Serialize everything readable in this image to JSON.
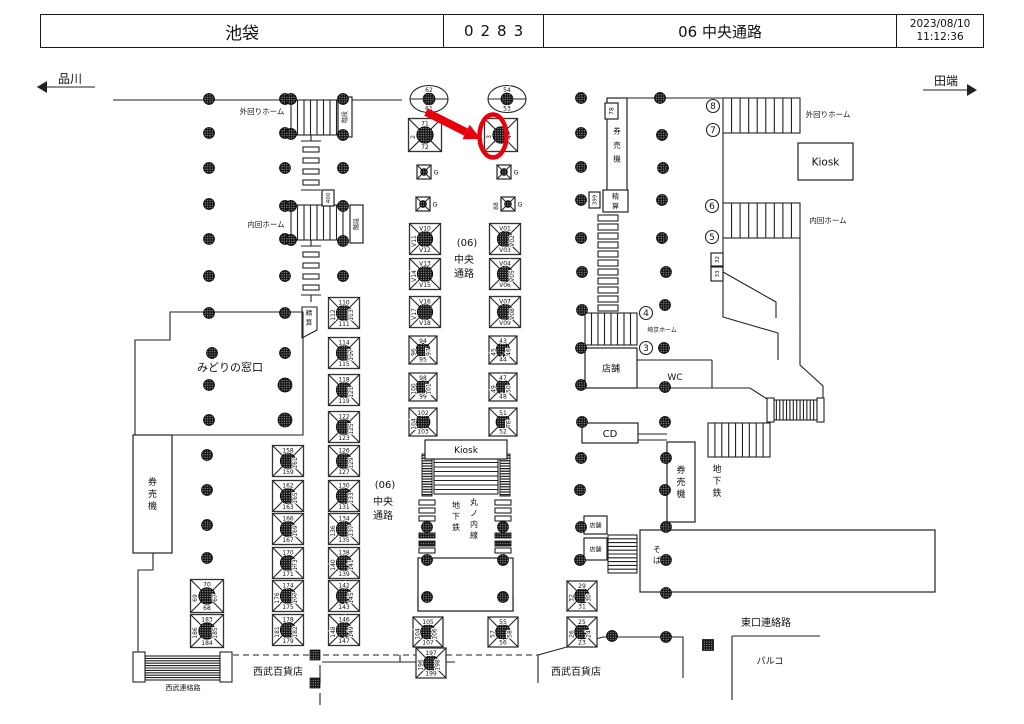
{
  "header": {
    "station": "池袋",
    "code": "0283",
    "location": "06 中央通路",
    "date": "2023/08/10",
    "time": "11:12:36"
  },
  "directions": {
    "left": "品川",
    "right": "田端"
  },
  "annotation": {
    "color": "#e8000b",
    "arrow": [
      426,
      112,
      466,
      132
    ],
    "arrow_head": [
      [
        481,
        139
      ],
      [
        462.4,
        139.2
      ],
      [
        469.6,
        124.8
      ]
    ],
    "ellipse": [
      493,
      136,
      13.5,
      21.5
    ]
  },
  "map": {
    "labels": [
      {
        "t": "品川",
        "x": 70,
        "y": 83,
        "s": 12,
        "n": "direction-left-label"
      },
      {
        "t": "田端",
        "x": 946,
        "y": 85,
        "s": 12,
        "n": "direction-right-label"
      },
      {
        "t": "外回りホーム",
        "x": 262,
        "y": 114,
        "s": 7.5
      },
      {
        "t": "内回ホーム",
        "x": 266,
        "y": 227,
        "s": 7.5
      },
      {
        "t": "外回りホーム",
        "x": 828,
        "y": 117,
        "s": 7.5
      },
      {
        "t": "内回ホーム",
        "x": 828,
        "y": 223,
        "s": 7.5
      },
      {
        "t": "みどりの窓口",
        "x": 230,
        "y": 371,
        "s": 11
      },
      {
        "t": "埼京ホーム",
        "x": 662,
        "y": 332,
        "s": 6
      },
      {
        "t": "WC",
        "x": 675,
        "y": 380,
        "s": 9
      },
      {
        "t": "東口連絡路",
        "x": 766,
        "y": 626,
        "s": 10
      },
      {
        "t": "パルコ",
        "x": 770,
        "y": 664,
        "s": 9
      },
      {
        "t": "西武百貨店",
        "x": 278,
        "y": 675,
        "s": 10
      },
      {
        "t": "西武百貨店",
        "x": 576,
        "y": 675,
        "s": 10
      },
      {
        "t": "西武連絡路",
        "x": 183,
        "y": 690,
        "s": 7
      },
      {
        "t": "(06)",
        "x": 467,
        "y": 246,
        "s": 10
      },
      {
        "t": "中央",
        "x": 464,
        "y": 263,
        "s": 10
      },
      {
        "t": "通路",
        "x": 464,
        "y": 277,
        "s": 10
      },
      {
        "t": "(06)",
        "x": 385,
        "y": 488,
        "s": 10
      },
      {
        "t": "中央",
        "x": 383,
        "y": 505,
        "s": 10
      },
      {
        "t": "通路",
        "x": 383,
        "y": 519,
        "s": 10
      },
      {
        "t": "地下鉄",
        "x": 456,
        "y": 508,
        "s": 8,
        "v": 1
      },
      {
        "t": "丸ノ内線",
        "x": 474,
        "y": 505,
        "s": 8,
        "v": 1
      },
      {
        "t": "地下鉄",
        "x": 717,
        "y": 472,
        "s": 9,
        "v": 1
      },
      {
        "t": "そば",
        "x": 657,
        "y": 552,
        "s": 8,
        "v": 1
      },
      {
        "t": "精算",
        "x": 309,
        "y": 315,
        "s": 6.5,
        "v": 1
      }
    ],
    "boxes": [
      {
        "x": 425,
        "y": 440,
        "w": 82,
        "h": 19,
        "t": "Kiosk",
        "s": 9
      },
      {
        "x": 798,
        "y": 143,
        "w": 55,
        "h": 37,
        "t": "Kiosk",
        "s": 10.5
      },
      {
        "x": 582,
        "y": 423,
        "w": 56,
        "h": 20,
        "t": "CD",
        "s": 10
      },
      {
        "x": 585,
        "y": 348,
        "w": 52,
        "h": 40,
        "t": "店舗",
        "s": 9
      },
      {
        "x": 584,
        "y": 516,
        "w": 23,
        "h": 18,
        "t": "店舗",
        "s": 6
      },
      {
        "x": 584,
        "y": 538,
        "w": 23,
        "h": 22,
        "t": "店舗",
        "s": 6
      },
      {
        "x": 418,
        "y": 597,
        "w": 95,
        "h": 14,
        "t": "店舗",
        "s": 9
      },
      {
        "x": 133,
        "y": 435,
        "w": 39,
        "h": 118,
        "t": "券売機",
        "s": 9,
        "v": 1
      },
      {
        "x": 607,
        "y": 98,
        "w": 20,
        "h": 94,
        "t": "券売機",
        "s": 7.5,
        "v": 1,
        "dy": 14
      },
      {
        "x": 667,
        "y": 442,
        "w": 28,
        "h": 80,
        "t": "券売機",
        "s": 9,
        "v": 1
      },
      {
        "x": 603,
        "y": 190,
        "w": 25,
        "h": 22,
        "t": "精算",
        "s": 7,
        "v": 1
      },
      {
        "x": 605,
        "y": 103,
        "w": 13,
        "h": 16,
        "t": "78",
        "s": 6,
        "r": 1
      },
      {
        "x": 589,
        "y": 192,
        "w": 11,
        "h": 16,
        "t": "399",
        "s": 5.5,
        "r": 1
      },
      {
        "x": 322,
        "y": 190,
        "w": 12,
        "h": 16,
        "t": "400",
        "s": 5.5,
        "r": 1
      },
      {
        "x": 711,
        "y": 253,
        "w": 12,
        "h": 13,
        "t": "32",
        "s": 5.5,
        "r": 1
      },
      {
        "x": 711,
        "y": 267,
        "w": 12,
        "h": 14,
        "t": "33",
        "s": 5.5,
        "r": 1
      },
      {
        "x": 338,
        "y": 97,
        "w": 14,
        "h": 40,
        "t": "階段",
        "s": 6,
        "r": 1
      },
      {
        "x": 350,
        "y": 205,
        "w": 13,
        "h": 38,
        "t": "階段",
        "s": 6,
        "r": 1
      },
      {
        "x": 640,
        "y": 530,
        "w": 295,
        "h": 62
      },
      {
        "x": 418,
        "y": 558,
        "w": 95,
        "h": 53
      }
    ],
    "signs": [
      [
        425,
        135,
        33,
        "71",
        "2",
        null,
        "72"
      ],
      [
        501,
        135,
        33,
        null,
        "3",
        "4",
        null
      ],
      [
        425,
        239,
        31,
        "V10",
        "V11",
        null,
        "V12"
      ],
      [
        425,
        274,
        31,
        "V13",
        "V14",
        null,
        "V15"
      ],
      [
        425,
        312,
        31,
        "V16",
        "V17",
        null,
        "V18"
      ],
      [
        505,
        239,
        31,
        "V01",
        null,
        "V02",
        "V03"
      ],
      [
        505,
        274,
        31,
        "V04",
        null,
        "V05",
        "V06"
      ],
      [
        505,
        312,
        31,
        "V07",
        null,
        "V08",
        "V09"
      ],
      [
        423,
        350,
        28,
        "94",
        "96",
        "97",
        "95"
      ],
      [
        423,
        387,
        28,
        "98",
        "100",
        "101",
        "99"
      ],
      [
        423,
        422,
        28,
        "102",
        "104",
        null,
        "103"
      ],
      [
        503,
        350,
        28,
        "43",
        "45",
        "46",
        "44"
      ],
      [
        503,
        387,
        28,
        "47",
        "49",
        "50",
        "48"
      ],
      [
        503,
        422,
        28,
        "51",
        null,
        "TC",
        "52"
      ],
      [
        344,
        313,
        31,
        "110",
        "112",
        "113",
        "111"
      ],
      [
        344,
        353,
        31,
        "114",
        null,
        "117",
        "115"
      ],
      [
        344,
        390,
        31,
        "118",
        null,
        "121",
        "119"
      ],
      [
        344,
        427,
        31,
        "122",
        null,
        "125",
        "123"
      ],
      [
        344,
        461,
        31,
        "126",
        null,
        "129",
        "127"
      ],
      [
        344,
        496,
        31,
        "130",
        null,
        "133",
        "131"
      ],
      [
        344,
        529,
        31,
        "134",
        "136",
        "137",
        "135"
      ],
      [
        344,
        563,
        31,
        "138",
        "140",
        "141",
        "139"
      ],
      [
        344,
        596,
        31,
        "142",
        null,
        "145",
        "143"
      ],
      [
        344,
        630,
        31,
        "146",
        "148",
        "149",
        "147"
      ],
      [
        288,
        461,
        31,
        "158",
        null,
        "161",
        "159"
      ],
      [
        288,
        496,
        31,
        "162",
        null,
        "165",
        "163"
      ],
      [
        288,
        529,
        31,
        "166",
        null,
        "169",
        "167"
      ],
      [
        288,
        563,
        31,
        "170",
        null,
        "173",
        "171"
      ],
      [
        288,
        596,
        31,
        "174",
        "176",
        "177",
        "175"
      ],
      [
        288,
        630,
        31,
        "178",
        "181",
        "182",
        "179"
      ],
      [
        207,
        596,
        33,
        "70",
        "69",
        "67",
        "68"
      ],
      [
        207,
        631,
        33,
        "183",
        "186",
        "185",
        "184"
      ],
      [
        428,
        632,
        30,
        "105",
        "104",
        "106",
        "107"
      ],
      [
        503,
        632,
        30,
        "55",
        "57",
        "58",
        "56"
      ],
      [
        431,
        663,
        30,
        "197",
        "196",
        "198",
        "199"
      ],
      [
        582,
        596,
        30,
        "29",
        "32",
        "30",
        "31"
      ],
      [
        582,
        632,
        30,
        "25",
        "26",
        "24",
        "23"
      ]
    ],
    "g_signs": [
      [
        424,
        172,
        "G",
        null
      ],
      [
        504,
        172,
        "G",
        null
      ],
      [
        423,
        204,
        "G",
        null
      ],
      [
        508,
        204,
        "G",
        "88"
      ]
    ],
    "ellipse_pillars": [
      [
        429,
        99,
        "62",
        "61"
      ],
      [
        507,
        99,
        "54",
        "53"
      ]
    ],
    "circled_numbers": [
      [
        713,
        106,
        "8"
      ],
      [
        713,
        130,
        "7"
      ],
      [
        712,
        206,
        "6"
      ],
      [
        712,
        237,
        "5"
      ],
      [
        646,
        313,
        "4"
      ],
      [
        646,
        348,
        "3"
      ]
    ],
    "stairs": [
      [
        291,
        100,
        52,
        35,
        "v",
        7
      ],
      [
        291,
        205,
        52,
        35,
        "v",
        7
      ],
      [
        723,
        98,
        77,
        35,
        "v",
        8
      ],
      [
        723,
        203,
        77,
        35,
        "v",
        8
      ],
      [
        585,
        313,
        52,
        32,
        "v",
        7
      ],
      [
        434,
        458,
        64,
        36,
        "h",
        7
      ],
      [
        428,
        562,
        74,
        31,
        "h",
        8
      ],
      [
        145,
        656,
        75,
        24,
        "h",
        9
      ],
      [
        708,
        423,
        62,
        34,
        "v",
        8
      ],
      [
        773,
        400,
        44,
        20,
        "v",
        12
      ],
      [
        608,
        535,
        29,
        38,
        "h",
        9
      ]
    ],
    "escalator_strips": [
      [
        422,
        454,
        10,
        42
      ],
      [
        500,
        454,
        10,
        42
      ]
    ],
    "caps": [
      [
        133,
        652,
        12,
        30
      ],
      [
        220,
        652,
        12,
        30
      ],
      [
        767,
        398,
        7,
        24
      ],
      [
        817,
        398,
        7,
        24
      ],
      [
        420,
        562,
        8,
        31
      ],
      [
        502,
        562,
        8,
        31
      ]
    ],
    "ladders": [
      {
        "x": 303,
        "w": 16,
        "h": 5,
        "ys": [
          147,
          158,
          169,
          180
        ]
      },
      {
        "x": 303,
        "w": 16,
        "h": 5,
        "ys": [
          252,
          263,
          274,
          285
        ]
      },
      {
        "x": 598,
        "w": 20,
        "h": 6,
        "ys": [
          215,
          224,
          233,
          242,
          251,
          260,
          269,
          278,
          287,
          296,
          305
        ]
      },
      {
        "x": 419,
        "w": 16,
        "h": 5,
        "ys": [
          500,
          508,
          516,
          548
        ],
        "dys": [
          533,
          541
        ]
      },
      {
        "x": 495,
        "w": 16,
        "h": 5,
        "ys": [
          500,
          508,
          516,
          548
        ],
        "dys": [
          533,
          541
        ]
      }
    ],
    "pillars": [
      [
        209,
        99
      ],
      [
        209,
        133
      ],
      [
        209,
        168
      ],
      [
        209,
        204
      ],
      [
        209,
        239
      ],
      [
        209,
        276
      ],
      [
        209,
        313
      ],
      [
        212,
        353
      ],
      [
        209,
        385
      ],
      [
        209,
        420
      ],
      [
        207,
        455
      ],
      [
        207,
        490
      ],
      [
        207,
        525
      ],
      [
        207,
        558
      ],
      [
        285,
        99
      ],
      [
        285,
        133
      ],
      [
        285,
        168
      ],
      [
        285,
        206
      ],
      [
        285,
        239
      ],
      [
        285,
        276
      ],
      [
        285,
        313
      ],
      [
        285,
        353
      ],
      [
        285,
        385,
        7
      ],
      [
        285,
        420,
        7
      ],
      [
        343,
        168
      ],
      [
        343,
        276
      ],
      [
        291,
        99
      ],
      [
        291,
        134
      ],
      [
        343,
        99
      ],
      [
        343,
        135
      ],
      [
        291,
        206
      ],
      [
        291,
        240
      ],
      [
        343,
        206
      ],
      [
        343,
        241
      ],
      [
        581,
        98
      ],
      [
        581,
        133
      ],
      [
        581,
        167
      ],
      [
        581,
        200
      ],
      [
        581,
        238
      ],
      [
        582,
        272
      ],
      [
        582,
        310
      ],
      [
        581,
        348
      ],
      [
        581,
        385
      ],
      [
        582,
        422
      ],
      [
        581,
        458
      ],
      [
        580,
        490
      ],
      [
        581,
        527
      ],
      [
        580,
        560
      ],
      [
        660,
        98
      ],
      [
        662,
        135
      ],
      [
        663,
        168
      ],
      [
        662,
        200
      ],
      [
        662,
        238
      ],
      [
        666,
        272
      ],
      [
        665,
        305
      ],
      [
        664,
        348
      ],
      [
        665,
        387
      ],
      [
        665,
        422
      ],
      [
        666,
        458
      ],
      [
        665,
        490
      ],
      [
        666,
        527
      ],
      [
        666,
        560
      ],
      [
        666,
        593
      ],
      [
        666,
        637
      ],
      [
        612,
        636
      ],
      [
        427,
        527
      ],
      [
        503,
        527
      ],
      [
        427,
        560
      ],
      [
        503,
        560
      ],
      [
        427,
        597
      ],
      [
        503,
        597
      ]
    ],
    "square_pillars": [
      [
        315,
        655,
        10
      ],
      [
        315,
        683,
        10
      ],
      [
        708,
        645,
        11
      ]
    ]
  }
}
